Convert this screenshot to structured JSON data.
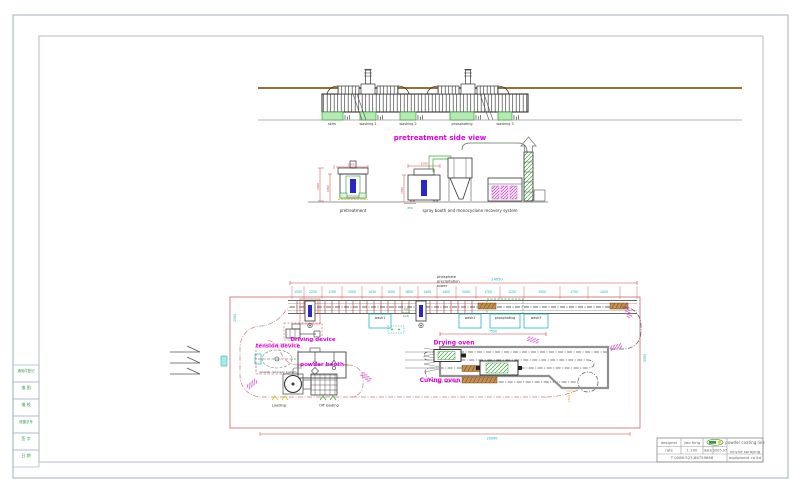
{
  "frame": {
    "left_rows": [
      "通用件登记",
      "描 图",
      "描 校",
      "底图总号",
      "签 字",
      "日 期"
    ]
  },
  "side_view": {
    "title": "pretreatment side view",
    "tanks": [
      "skim",
      "washing 1",
      "washing 2",
      "phosphating",
      "washing 3"
    ]
  },
  "elevations": {
    "pretreatment_label": "pretreatment",
    "spray_label": "spray booth and monocyclone recovery system",
    "dims": {
      "left_height": "2300",
      "left_inner": "1650",
      "left_width": "1400",
      "booth_height": "2350",
      "booth_width": "1500",
      "booth_base": "850"
    }
  },
  "plan": {
    "total_dim": "24050",
    "bottom_dim": "20000",
    "right_dim": "5500",
    "left_dim": "1500",
    "oven_dim": "7500",
    "ext_dim": "1500",
    "tower_note": [
      "phosphate",
      "precipitation",
      "tower"
    ],
    "hot_water": [
      "hot",
      "water",
      "tank"
    ],
    "dims": [
      "1500",
      "2250",
      "1700",
      "2000",
      "1450",
      "1000",
      "1800",
      "1445",
      "1400",
      "2000",
      "1700",
      "1250",
      "1500",
      "1750",
      "2000"
    ],
    "tanks": [
      "wash1",
      "wash2",
      "phosphating",
      "wash3"
    ],
    "labels": {
      "driving": "Driving device",
      "tension": "tension device",
      "booth": "powder booth",
      "recovery": "powder recovery system",
      "drying": "Drying oven",
      "curing": "Curing oven",
      "loading": "Loading",
      "offloading": "Off loading"
    }
  },
  "title_block": {
    "designer_label": "designer",
    "designer": "jiao feng",
    "rate_label": "rate",
    "rate": "1:100",
    "date_label": "date",
    "date": "2005.07",
    "phone": "T 0086-523-86759666",
    "product": "powder coating line",
    "company_line1": "xinyue spraying",
    "company_line2": "equipment co.ltd"
  },
  "colors": {
    "magenta": "#e100e1",
    "red": "#cc4444",
    "cyan": "#00b4b4",
    "green": "#2fa04a",
    "brown": "#96722e",
    "blue": "#2828c8",
    "tank_green": "#b2ecb2"
  }
}
